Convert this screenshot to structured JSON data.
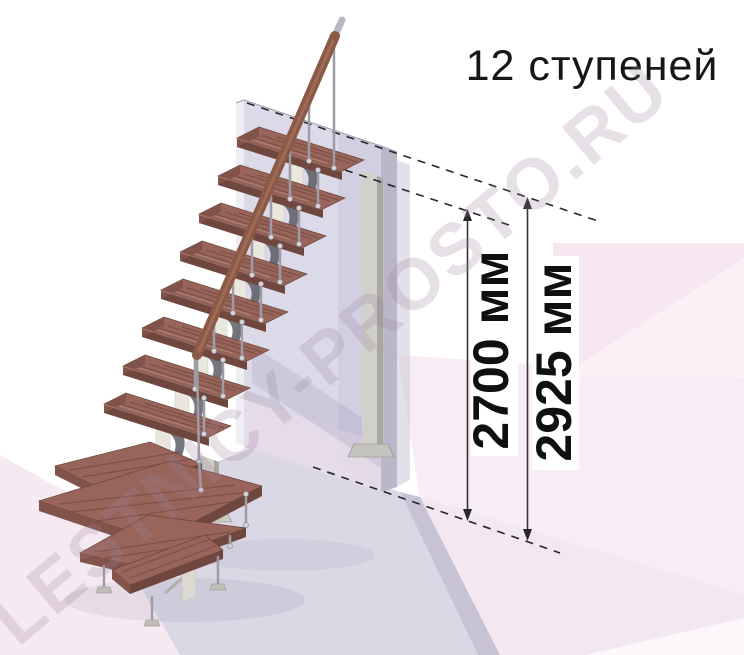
{
  "title": "12 ступеней",
  "watermark": "LESTNICY-PROSTO.RU",
  "dimensions": [
    {
      "id": "height-to-top-tread",
      "label": "2700 мм",
      "value_mm": 2700
    },
    {
      "id": "height-total",
      "label": "2925 мм",
      "value_mm": 2925
    }
  ],
  "stairs": {
    "steps_count": 12
  },
  "colors": {
    "tread_top": "#99655a",
    "tread_front": "#70473e",
    "handrail": "#8a5a46",
    "metal": "#9e9da7",
    "wall_face": "#dcdae8",
    "wall_side": "#bbb7c9",
    "floor_platform": "#dbd8e6",
    "background_pink": "#f7e7f0",
    "dimension_text": "#101010",
    "title_text": "#161616"
  }
}
